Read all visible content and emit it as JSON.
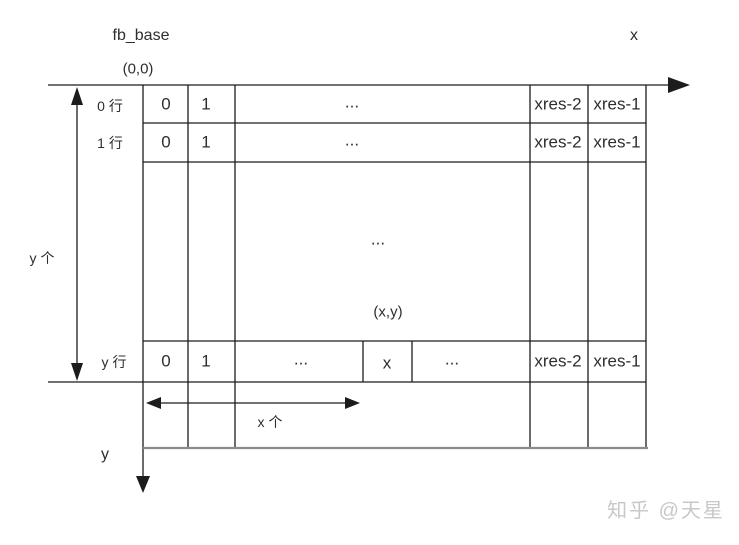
{
  "labels": {
    "fb_base": "fb_base",
    "origin": "(0,0)",
    "x_axis": "x",
    "y_axis": "y",
    "row0": "0 行",
    "row1": "1 行",
    "rowy": "y 行",
    "y_count": "y 个",
    "x_count": "x 个"
  },
  "table": {
    "row0_cells": [
      "0",
      "1",
      "...",
      "xres-2",
      "xres-1"
    ],
    "row1_cells": [
      "0",
      "1",
      "...",
      "xres-2",
      "xres-1"
    ],
    "mid_cell": {
      "ellipsis": "...",
      "coord": "(x,y)"
    },
    "rowy_cells": [
      "0",
      "1",
      "...",
      "x",
      "...",
      "xres-2",
      "xres-1"
    ]
  },
  "colors": {
    "line": "#1c1c1c",
    "bottom_line": "#8c8c8c",
    "text": "#2b2b2b",
    "watermark": "#c8c8c8",
    "background": "#ffffff"
  },
  "watermark": "知乎 @天星"
}
